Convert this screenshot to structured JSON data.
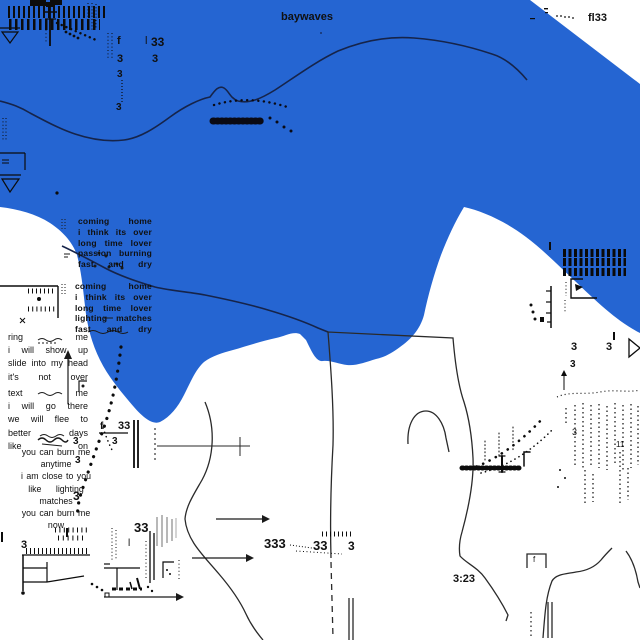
{
  "artwork": {
    "title": "baywaves",
    "corner_label": "fl33",
    "timecode": "3:23",
    "colors": {
      "sea_blue": "#2565d2",
      "contour_navy": "#16244a",
      "ink": "#141414",
      "thin_line": "#2a2a2a",
      "gray_streak": "#b8b8b8",
      "paper": "#ffffff"
    },
    "lyrics": {
      "block1": {
        "lines": [
          "coming home",
          "i think its over",
          "long time lover",
          "passion burning",
          "fast and dry"
        ]
      },
      "block2": {
        "lines": [
          "coming home",
          "i think its over",
          "long time lover",
          "lighting matches",
          "fast and dry"
        ]
      },
      "block3": {
        "lines": [
          "ring me",
          "i will show up",
          "slide into my head",
          "it's not over"
        ]
      },
      "block4": {
        "lines": [
          "text me",
          "i will go there",
          "we will flee to",
          "better days",
          "like on"
        ]
      },
      "block5": {
        "lines": [
          "you can burn me",
          "anytime",
          "i am close to you",
          "like lighting",
          "matches",
          "you can burn me",
          "now"
        ]
      }
    },
    "marks": {
      "f_top": "f",
      "bar_top": "l",
      "n33_top": "33",
      "n3_a": "3",
      "n3_b": "3",
      "n3_c": "3",
      "n3_d": "3",
      "n3_e": "3",
      "n3_f": "3",
      "n3_g": "3",
      "n3_tex": "3",
      "n11": "11",
      "f_mid": "f",
      "n33_mid": "33",
      "n3_h": "3",
      "n3_i": "3",
      "n3_j": "3",
      "n3_k": "3",
      "n3_l": "3",
      "n33_bot": "33",
      "bar_bot": "l",
      "n333": "333",
      "n33_c": "33",
      "n3_m": "3",
      "f_box": "f"
    }
  }
}
